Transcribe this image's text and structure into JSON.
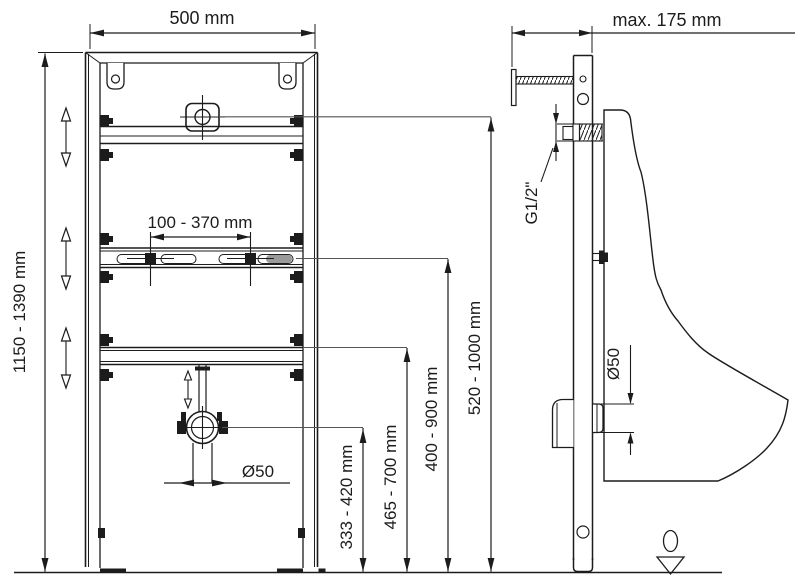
{
  "drawing": {
    "front_view": {
      "frame_width": "500 mm",
      "frame_height_range": "1150 - 1390 mm",
      "fixing_bolt_spacing_range": "100 - 370 mm",
      "drain_pipe_diameter": "Ø50",
      "drain_height_range": "333 - 420 mm",
      "lower_rail_height_range": "465 - 700 mm",
      "middle_rail_height_range": "400 - 900 mm",
      "water_supply_height_range": "520 - 1000 mm"
    },
    "side_view": {
      "max_wall_distance": "max. 175 mm",
      "water_connection_thread": "G1/2\"",
      "outlet_diameter": "Ø50"
    }
  }
}
